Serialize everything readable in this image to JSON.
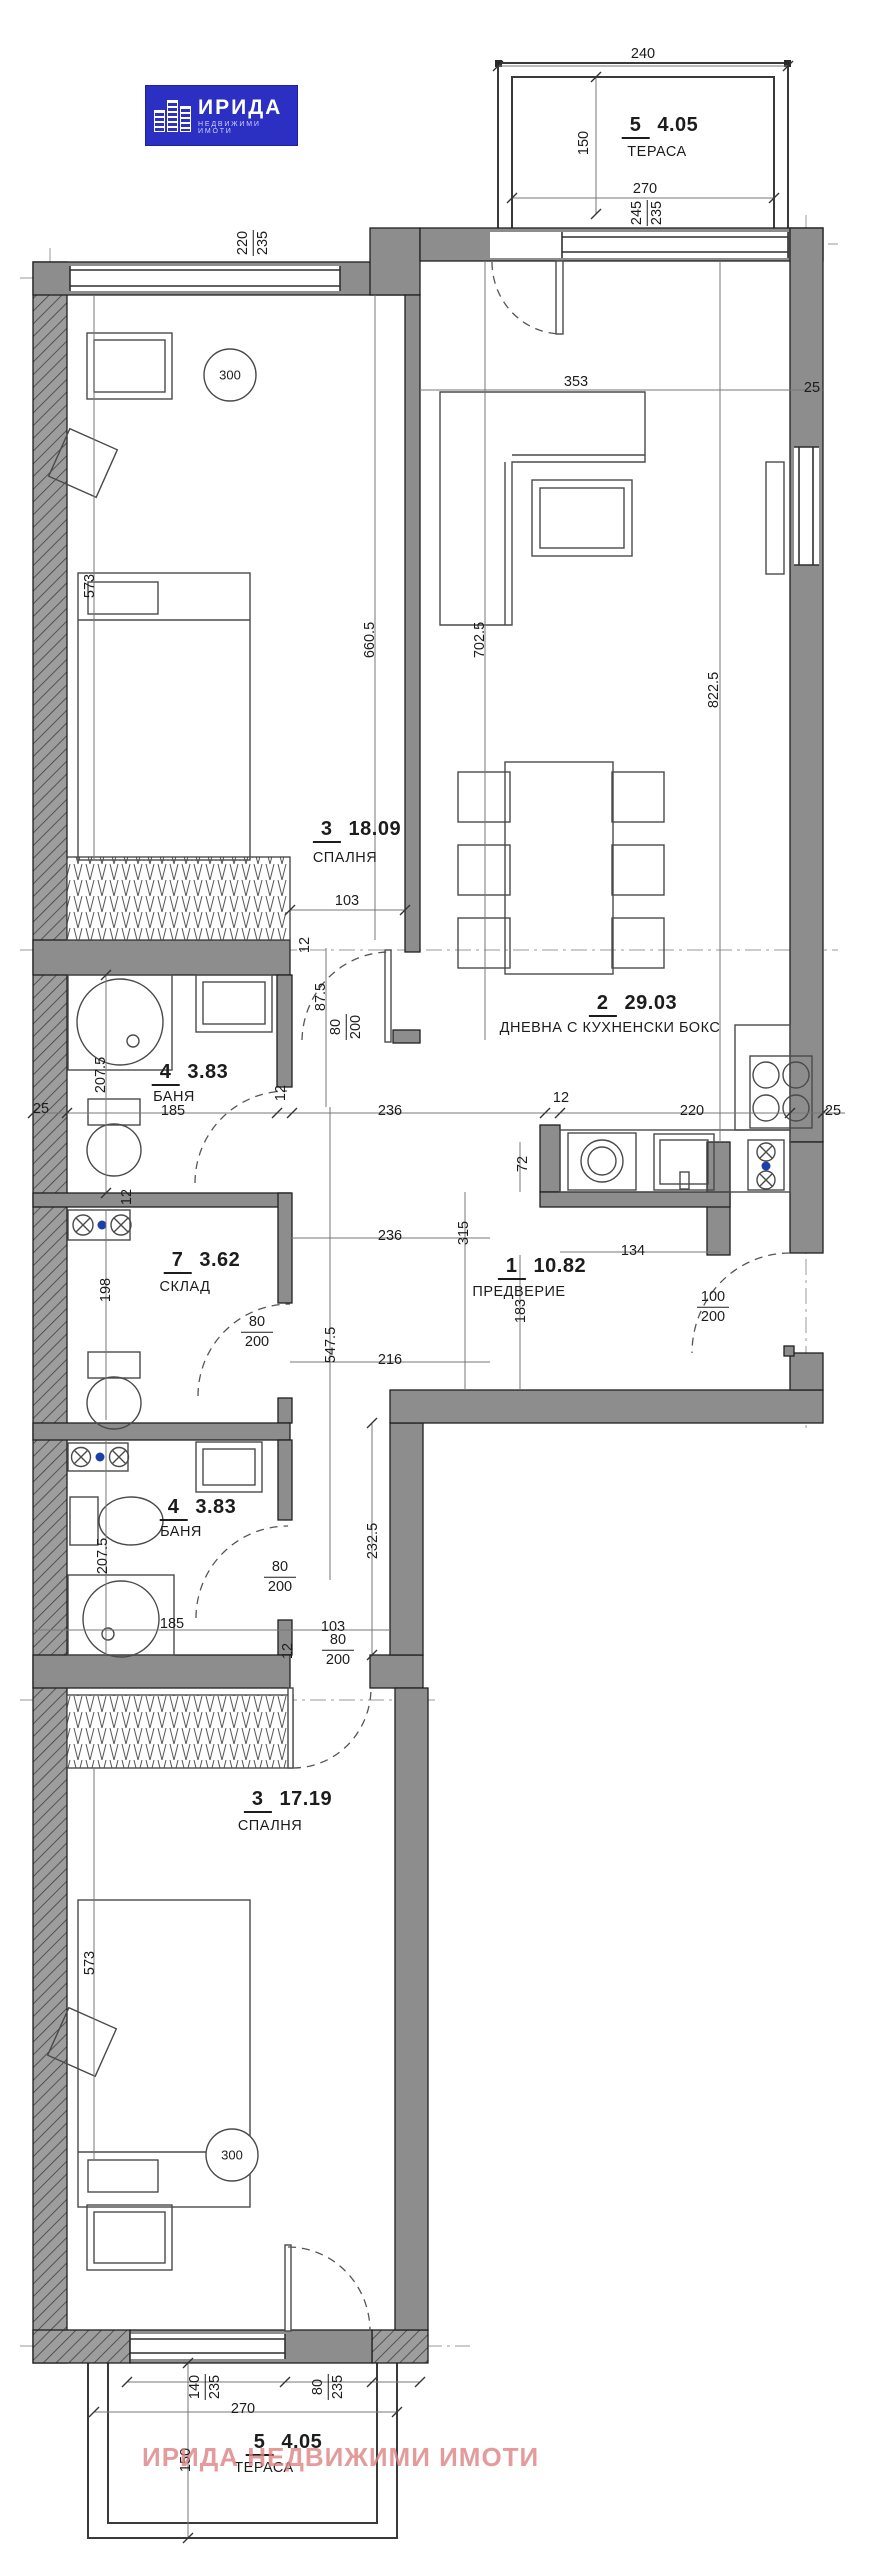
{
  "logo": {
    "title": "ИРИДА",
    "subtitle": "НЕДВИЖИМИ ИМОТИ"
  },
  "watermark": "ИРИДА НЕДВИЖИМИ ИМОТИ",
  "rooms": {
    "terrace_top": {
      "number": "5",
      "area": "4.05",
      "name": "ТЕРАСА"
    },
    "bedroom1": {
      "number": "3",
      "area": "18.09",
      "name": "СПАЛНЯ"
    },
    "living": {
      "number": "2",
      "area": "29.03",
      "name": "ДНЕВНА С КУХНЕНСКИ БОКС"
    },
    "bathroom1": {
      "number": "4",
      "area": "3.83",
      "name": "БАНЯ"
    },
    "storage": {
      "number": "7",
      "area": "3.62",
      "name": "СКЛАД"
    },
    "hall": {
      "number": "1",
      "area": "10.82",
      "name": "ПРЕДВЕРИЕ"
    },
    "bathroom2": {
      "number": "4",
      "area": "3.83",
      "name": "БАНЯ"
    },
    "bedroom2": {
      "number": "3",
      "area": "17.19",
      "name": "СПАЛНЯ"
    },
    "terrace_bottom": {
      "number": "5",
      "area": "4.05",
      "name": "ТЕРАСА"
    }
  },
  "dims": {
    "d240": "240",
    "d150_top": "150",
    "d270_top": "270",
    "f245": "245",
    "f235a": "235",
    "f220": "220",
    "f235b": "235",
    "d353": "353",
    "d25_right": "25",
    "d822": "822.5",
    "d702": "702.5",
    "d660": "660.5",
    "d573_b1": "573",
    "d300_b1": "300",
    "d103_b1": "103",
    "d87": "87.5",
    "f80_b1": "80",
    "f200_b1": "200",
    "d12_b1": "12",
    "d207_bath1": "207.5",
    "d185_bath1": "185",
    "d25_left": "25",
    "d12_w1": "12",
    "d12_w2": "12",
    "d12_k": "12",
    "d220_k": "220",
    "d25_k": "25",
    "d236_a": "236",
    "d72": "72",
    "d315": "315",
    "d134": "134",
    "f100_entry": "100",
    "f200_entry": "200",
    "d236_b": "236",
    "d183": "183",
    "d198": "198",
    "d547": "547.5",
    "f80_st": "80",
    "f200_st": "200",
    "d216": "216",
    "d207_bath2": "207.5",
    "f80_bath2": "80",
    "f200_bath2": "200",
    "d232": "232.5",
    "d185_bath2": "185",
    "d103_b2": "103",
    "f80_b2": "80",
    "f200_b2": "200",
    "d12_b2": "12",
    "d573_b2": "573",
    "d300_b2": "300",
    "f140": "140",
    "f235c": "235",
    "f80_t": "80",
    "f235d": "235",
    "d270_bot": "270",
    "d150_bot": "150"
  }
}
